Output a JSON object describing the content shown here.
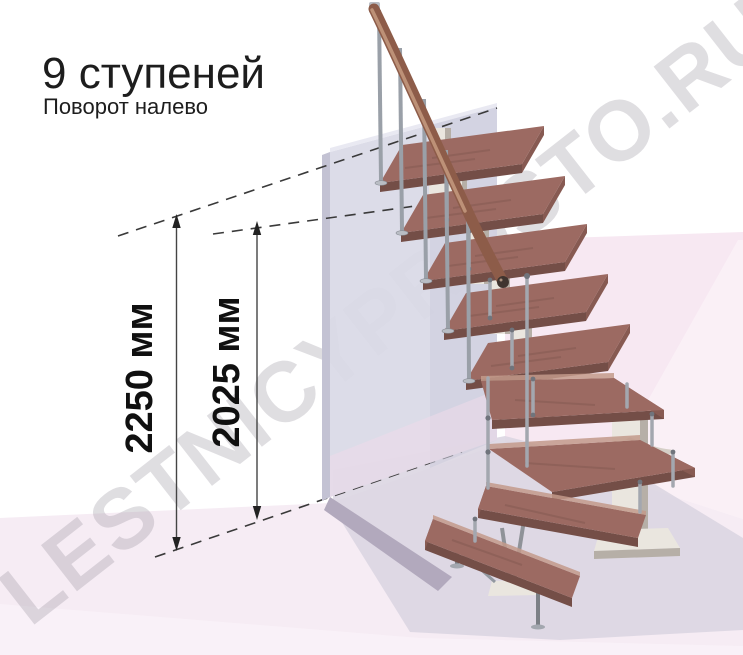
{
  "header": {
    "title": "9 ступеней",
    "subtitle": "Поворот налево"
  },
  "dimensions": {
    "overall_height_label": "2250 мм",
    "upper_level_label": "2025 мм"
  },
  "watermark": {
    "text": "LESTNICYPROSTO.RU"
  },
  "stairs": {
    "steps_total": "9",
    "turn_direction": "налево"
  },
  "colors": {
    "background": "#ffffff",
    "floor": "#f6ecf4",
    "floor_shadow": "#dcd6e2",
    "floor_front": "#fbf4f9",
    "pink_wall": "#f7e8f2",
    "wall_back": "#d9d9e6",
    "wall_edge": "#c3c2d3",
    "wall_dark_base": "#b2a9bd",
    "wood_top": "#9c6a62",
    "wood_front": "#744e47",
    "wood_side": "#875a52",
    "wood_light": "#c39a8b",
    "rail": "#8d5c49",
    "rail_highlight": "#c59a7f",
    "metal": "#a3a7af",
    "metal_dark": "#70747c",
    "spine": "#eae6df",
    "spine_shadow": "#b6afa7",
    "dim_color": "#222222",
    "text_color": "#1d1d1d",
    "watermark_color": "#8f8a96"
  }
}
